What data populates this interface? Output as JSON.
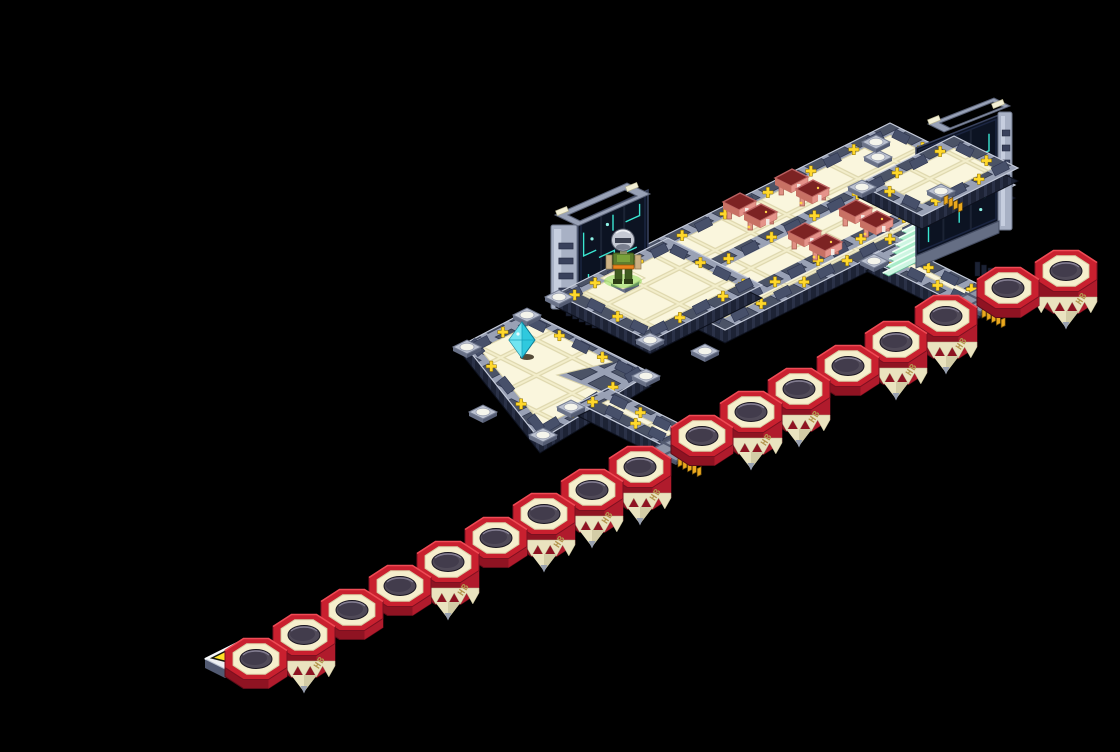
{
  "scene": {
    "name": "isometric-cyber-area-map",
    "background": "#000000"
  },
  "palette": {
    "red": "#c9202f",
    "redMid": "#b01b2c",
    "redDark": "#8f1322",
    "redEdge": "#ef4b55",
    "cream": "#f6efcd",
    "creamShade": "#eae3bf",
    "gold": "#b3954e",
    "plus": "#ffd82c",
    "borderGray": "#99a1b5",
    "borderDark": "#47506a",
    "skirt": "#1d2335",
    "screenDark": "#0c1322",
    "trace": "#3ae6d2",
    "mint": "#a9ecc9",
    "mintLight": "#cdf6e2",
    "crystal": "#2fc9de",
    "glow": "#76d83a",
    "pin": "#eaa81e",
    "arrow": "#ffe227",
    "deskPink": "#e5938a",
    "deskTop": "#7c2323"
  },
  "chain": {
    "label": "HB",
    "octagons": [
      {
        "x": 1066,
        "y": 271,
        "tall": true
      },
      {
        "x": 1008,
        "y": 288,
        "tall": false
      },
      {
        "x": 946,
        "y": 316,
        "tall": true
      },
      {
        "x": 896,
        "y": 342,
        "tall": true
      },
      {
        "x": 848,
        "y": 366,
        "tall": false
      },
      {
        "x": 799,
        "y": 389,
        "tall": true
      },
      {
        "x": 751,
        "y": 412,
        "tall": true
      },
      {
        "x": 702,
        "y": 436,
        "tall": false
      },
      {
        "x": 640,
        "y": 467,
        "tall": true
      },
      {
        "x": 592,
        "y": 490,
        "tall": true
      },
      {
        "x": 544,
        "y": 514,
        "tall": true
      },
      {
        "x": 496,
        "y": 538,
        "tall": false
      },
      {
        "x": 448,
        "y": 562,
        "tall": true
      },
      {
        "x": 400,
        "y": 586,
        "tall": false
      },
      {
        "x": 352,
        "y": 610,
        "tall": false
      },
      {
        "x": 304,
        "y": 635,
        "tall": true
      },
      {
        "x": 256,
        "y": 659,
        "tall": false
      }
    ]
  },
  "platforms": {
    "slab": {
      "name": "main-deck",
      "outer": [
        [
          600,
          268
        ],
        [
          890,
          123
        ],
        [
          1015,
          185
        ],
        [
          725,
          330
        ]
      ],
      "bands": [
        52,
        104
      ]
    },
    "plazaRight": {
      "name": "right-plaza",
      "outer": [
        [
          858,
          184
        ],
        [
          954,
          136
        ],
        [
          1018,
          168
        ],
        [
          922,
          216
        ]
      ]
    },
    "plazaLeft": {
      "name": "left-plaza",
      "outer": [
        [
          556,
          294
        ],
        [
          668,
          238
        ],
        [
          762,
          285
        ],
        [
          650,
          341
        ]
      ]
    },
    "walkway": {
      "name": "lower-walkway",
      "outer": [
        [
          866,
          258
        ],
        [
          896,
          243
        ],
        [
          1000,
          295
        ],
        [
          970,
          310
        ]
      ]
    },
    "lPlatform": {
      "name": "l-platform",
      "outer": [
        [
          527,
          311
        ],
        [
          651,
          373
        ],
        [
          540,
          440
        ],
        [
          464,
          344
        ]
      ],
      "inner": [
        [
          534,
          323
        ],
        [
          612,
          362
        ],
        [
          557,
          375
        ],
        [
          606,
          394
        ],
        [
          543,
          426
        ],
        [
          480,
          349
        ]
      ]
    },
    "bridge": {
      "name": "bridge-path",
      "outer": [
        [
          578,
          403
        ],
        [
          608,
          388
        ],
        [
          698,
          433
        ],
        [
          668,
          448
        ]
      ]
    }
  },
  "stairs": {
    "x": 902,
    "y": 231,
    "steps": 7
  },
  "monitors": [
    {
      "name": "left-monitor",
      "screen": [
        [
          578,
          222
        ],
        [
          648,
          190
        ],
        [
          648,
          262
        ],
        [
          578,
          295
        ]
      ],
      "ring": "M555,215 L627,183 L650,194 L578,226 Z M568,215 L625,190 L637,196 L580,221 Z",
      "pads": [
        [
          562,
          211
        ],
        [
          632,
          187
        ]
      ],
      "tower": {
        "x": 551,
        "y": 225,
        "w": 26,
        "h": 84
      },
      "base": [
        [
          578,
          295
        ],
        [
          648,
          262
        ],
        [
          648,
          272
        ],
        [
          578,
          305
        ]
      ],
      "ribs": {
        "x": 566,
        "y": 302,
        "n": 5
      }
    },
    {
      "name": "right-monitor",
      "screen": [
        [
          916,
          148
        ],
        [
          999,
          115
        ],
        [
          999,
          221
        ],
        [
          916,
          256
        ]
      ],
      "ring": "M928,124 L994,98 L1010,106 L944,132 Z M940,123 L993,102 L1003,107 L950,128 Z",
      "pads": [
        [
          934,
          120
        ],
        [
          998,
          104
        ]
      ],
      "tower": {
        "x": 998,
        "y": 112,
        "w": 14,
        "h": 118
      },
      "base": [
        [
          916,
          256
        ],
        [
          999,
          221
        ],
        [
          999,
          233
        ],
        [
          916,
          268
        ]
      ],
      "ribs": {
        "x": 975,
        "y": 262,
        "n": 4
      }
    }
  ],
  "desks": [
    [
      751,
      215
    ],
    [
      803,
      191
    ],
    [
      816,
      245
    ],
    [
      867,
      222
    ]
  ],
  "cornerBlocks": [
    [
      527,
      315
    ],
    [
      646,
      376
    ],
    [
      543,
      435
    ],
    [
      467,
      347
    ],
    [
      571,
      407
    ],
    [
      483,
      412
    ],
    [
      559,
      297
    ],
    [
      650,
      340
    ],
    [
      705,
      351
    ],
    [
      878,
      157
    ],
    [
      862,
      187
    ],
    [
      941,
      191
    ],
    [
      874,
      261
    ],
    [
      964,
      302
    ],
    [
      625,
      282
    ],
    [
      876,
      142
    ]
  ],
  "connectors": [
    {
      "x": 980,
      "y": 300
    },
    {
      "x": 676,
      "y": 449
    }
  ],
  "pins": [
    {
      "x": 944,
      "y": 197,
      "n": 4
    },
    {
      "x": 246,
      "y": 667,
      "n": 3
    }
  ],
  "ramp": {
    "x": 205,
    "y": 641
  },
  "crystal": {
    "x": 522,
    "y": 338
  },
  "character": {
    "x": 623,
    "y": 256
  }
}
